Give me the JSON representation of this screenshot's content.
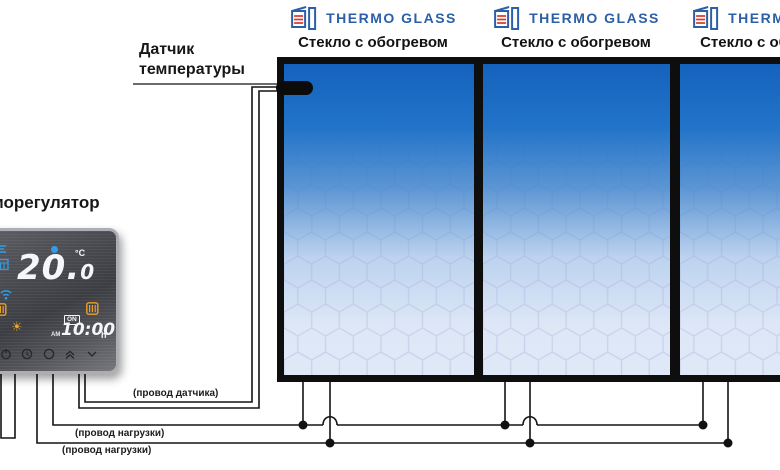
{
  "diagram_title": "Thermo Glass heated-glass wiring diagram",
  "labels": {
    "thermostat": "Терморегулятор",
    "sensor_line1": "Датчик",
    "sensor_line2": "температуры",
    "sensor_wire": "(провод датчика)",
    "load_wire_1": "(провод нагрузки)",
    "load_wire_2": "(провод нагрузки)"
  },
  "panels": [
    {
      "brand": "THERMO GLASS",
      "caption": "Стекло с обогревом"
    },
    {
      "brand": "THERMO GLASS",
      "caption": "Стекло с обогревом"
    },
    {
      "brand": "THERMO GLASS",
      "caption": "Стекло с обогревом"
    }
  ],
  "thermostat": {
    "temperature": "20.",
    "temperature_decimal": "0",
    "unit": "°C",
    "on_badge": "ON",
    "am_label": "AM",
    "time": "10:00",
    "time_unit": "h",
    "sun_icon": "☀"
  },
  "colors": {
    "brand_blue": "#2b5fa8",
    "heat_red": "#d63c30",
    "glass_top_blue": "#1462bd",
    "glass_bottom": "#dfe8f7",
    "hex_line": "#c9cde9",
    "display_icon_blue": "#2f9ee8",
    "display_icon_orange": "#e8a126",
    "wire_black": "#141414"
  },
  "icons": [
    "thermo-glass-logo-icon",
    "signal-icon",
    "calendar-icon",
    "wifi-icon",
    "heating-icon",
    "sun-icon",
    "power-icon",
    "clock-icon",
    "circle-icon",
    "chevron-up-icon",
    "chevron-down-icon"
  ]
}
